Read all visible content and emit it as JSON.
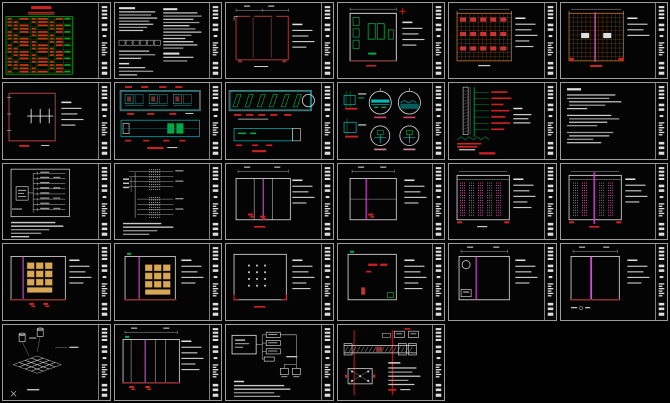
{
  "canvas": {
    "width": 670,
    "height": 403,
    "background": "#000000"
  },
  "grid": {
    "columns": 6,
    "rows": 5,
    "gap_px": 3,
    "sheet_count": 28
  },
  "palette": {
    "background": "#000000",
    "frame": "#9c9c9c",
    "sheet": "#040404",
    "white": "#dedede",
    "dim": "#9a9a9a",
    "dim2": "#c8c8c8",
    "green": "#00aa44",
    "tableGreen": "#00a000",
    "red": "#cc2222",
    "maroon": "#8a3030",
    "cyan": "#00b8b8",
    "teal2": "#008888",
    "orange": "#b06828",
    "orangeDim": "#7c4818",
    "magenta": "#dd44dd",
    "pink": "#d26aa8",
    "yellow": "#d8a855",
    "yellowEdge": "#a87830"
  },
  "title_strip": {
    "description": "vertical CAD title block at right edge of every sheet with small white label blocks top, middle and bottom"
  },
  "sheets": [
    {
      "id": "r1c1",
      "name": "drawing-list",
      "kind": "table_green",
      "desc": "Sheet index table, red entries on green grid with red title bar"
    },
    {
      "id": "r1c2",
      "name": "general-notes",
      "kind": "notes2col",
      "desc": "Design notes, two text columns with legend boxes"
    },
    {
      "id": "r1c3",
      "name": "wardrobe-plan",
      "kind": "plan_doors",
      "desc": "Maroon outlined plan with three panels and top dimension line"
    },
    {
      "id": "r1c4",
      "name": "room-plan",
      "kind": "plan_room",
      "desc": "Room plan with green fixtures and red cross mark"
    },
    {
      "id": "r1c5",
      "name": "ceiling-grid-a",
      "kind": "ceiling_grid",
      "opts": {
        "pink": false
      },
      "desc": "Orange ceiling grid with rows of red fittings"
    },
    {
      "id": "r1c6",
      "name": "ceiling-grid-b",
      "kind": "ceiling_grid",
      "opts": {
        "pink": true
      },
      "desc": "Orange ceiling grid with magenta centre line and white blocks"
    },
    {
      "id": "r2c1",
      "name": "room-plan-section-symbol",
      "kind": "plan_beam",
      "desc": "Maroon room plan with white section symbol"
    },
    {
      "id": "r2c2",
      "name": "elevation-strips",
      "kind": "strips_cyan",
      "desc": "Two cyan elevation strips with red dimension text"
    },
    {
      "id": "r2c3",
      "name": "glazing-elevation",
      "kind": "glazing",
      "desc": "Long elevation with diagonal green glazing panels and circle callout"
    },
    {
      "id": "r2c4",
      "name": "detail-callouts",
      "kind": "circles4",
      "desc": "Four circular detail callouts with cyan sections"
    },
    {
      "id": "r2c5",
      "name": "wall-section",
      "kind": "wallsec",
      "desc": "Vertical wall section, green leaders with red labels"
    },
    {
      "id": "r2c6",
      "name": "specification-notes",
      "kind": "notes",
      "desc": "Specification text sheet"
    },
    {
      "id": "r3c1",
      "name": "system-diagram",
      "kind": "sysdiag",
      "desc": "Distribution diagram with fan-out leader lines and notes"
    },
    {
      "id": "r3c2",
      "name": "column-detail",
      "kind": "secleaders",
      "desc": "Dotted hatched column detail with horizontal leaders"
    },
    {
      "id": "r3c3",
      "name": "elevation-three-panel",
      "kind": "elev",
      "desc": "Three panel elevation with magenta centre line",
      "opts": {
        "rect": [
          10,
          14,
          54,
          40
        ],
        "vline": 37,
        "panels": [
          28,
          46
        ],
        "redmarks": [
          [
            22,
            48
          ],
          [
            34,
            50
          ]
        ],
        "leaders": 4,
        "topDim": true,
        "botDash": true
      }
    },
    {
      "id": "r3c4",
      "name": "elevation-plain",
      "kind": "elev",
      "desc": "Plain elevation with magenta line",
      "opts": {
        "rect": [
          12,
          14,
          46,
          40
        ],
        "vline": 28,
        "hline": 34,
        "redmarks": [
          [
            30,
            48
          ]
        ],
        "leaders": 4,
        "topDim": true
      }
    },
    {
      "id": "r3c5",
      "name": "ceiling-plan-pink-a",
      "kind": "ceil_pink",
      "desc": "Ceiling plan with pink hatched bays",
      "opts": {
        "center": false
      }
    },
    {
      "id": "r3c6",
      "name": "ceiling-plan-pink-b",
      "kind": "ceil_pink",
      "desc": "Ceiling plan with pink bays and magenta centre line",
      "opts": {
        "center": true
      }
    },
    {
      "id": "r4c1",
      "name": "elevation-cabinets-left",
      "kind": "elev",
      "desc": "Elevation with yellow cabinet blocks at left",
      "opts": {
        "rect": [
          8,
          12,
          54,
          42
        ],
        "vline": 20,
        "yellow": [
          24,
          18,
          3,
          3
        ],
        "redmarks": [
          [
            26,
            57
          ],
          [
            40,
            57
          ]
        ],
        "leaders": 4,
        "maroonBase": true
      }
    },
    {
      "id": "r4c2",
      "name": "elevation-cabinets-right",
      "kind": "elev",
      "desc": "Elevation with yellow cabinet blocks at right",
      "opts": {
        "rect": [
          10,
          12,
          50,
          42
        ],
        "vline": 24,
        "yellow": [
          30,
          20,
          3,
          3
        ],
        "greenTick": true,
        "leaders": 4,
        "maroonBase": true
      }
    },
    {
      "id": "r4c3",
      "name": "elevation-dot-grid",
      "kind": "elev",
      "desc": "Elevation with grid of white dots and red corner marks",
      "opts": {
        "rect": [
          8,
          10,
          52,
          44
        ],
        "dots": [
          22,
          20,
          3,
          4
        ],
        "redcorners": true,
        "leaders": 5,
        "botDash": true
      }
    },
    {
      "id": "r4c4",
      "name": "elevation-red-marks",
      "kind": "elev",
      "desc": "Elevation with red annotation marks and green corner element",
      "opts": {
        "rect": [
          10,
          10,
          48,
          44
        ],
        "redtext": true,
        "greenBR": true,
        "greenTick": true,
        "leaders": 5
      }
    },
    {
      "id": "r4c5",
      "name": "elevation-circle-detail",
      "kind": "elev",
      "desc": "Elevation with circle callout and magenta line",
      "opts": {
        "rect": [
          10,
          12,
          50,
          42
        ],
        "vline": 27,
        "circle": [
          17,
          20
        ],
        "box": [
          12,
          44,
          10,
          7
        ],
        "leaders": 4,
        "topDim": true
      }
    },
    {
      "id": "r4c6",
      "name": "elevation-magenta-line",
      "kind": "elev",
      "desc": "Elevation with bright magenta centre line",
      "opts": {
        "rect": [
          10,
          12,
          48,
          42
        ],
        "vline": 30,
        "vw": 1.8,
        "maroonBase": true,
        "tinyBL": true,
        "leaders": 4,
        "topDim": true
      }
    },
    {
      "id": "r5c1",
      "name": "floor-tile-axonometric",
      "kind": "iso",
      "desc": "Isometric floor tile layout with fixture symbols"
    },
    {
      "id": "r5c2",
      "name": "elevation-verticals",
      "kind": "elev",
      "desc": "Elevation with vertical mullions and magenta line",
      "opts": {
        "rect": [
          8,
          14,
          56,
          42
        ],
        "vline": 30,
        "verts": [
          16,
          40,
          50
        ],
        "topDim": true,
        "maroonBase": true,
        "redmarks": [
          [
            14,
            59
          ],
          [
            30,
            59
          ]
        ],
        "leaders": 5,
        "greenTick": true
      }
    },
    {
      "id": "r5c3",
      "name": "wiring-flow-diagram",
      "kind": "flow",
      "desc": "Connection flow diagram with boxes and notes"
    },
    {
      "id": "r5c4",
      "name": "mounting-detail",
      "kind": "detailred",
      "desc": "Mounting detail with red datum lines and anchor plate"
    }
  ]
}
